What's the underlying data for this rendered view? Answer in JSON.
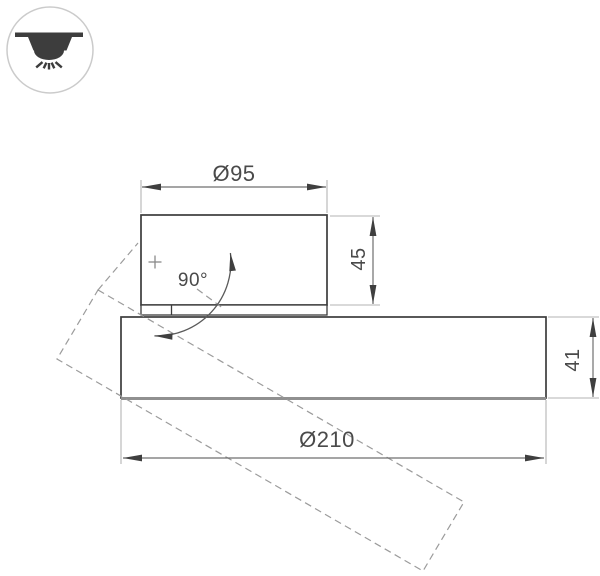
{
  "title": "luminaire-dimension-drawing",
  "badge": {
    "icon": "ceiling-downlight",
    "meaning": "surface ceiling mounted light"
  },
  "dimensions": {
    "top_diameter": "Ø95",
    "top_height": "45",
    "rotation_angle": "90°",
    "base_diameter": "Ø210",
    "base_height": "41"
  },
  "colors": {
    "solid_outline": "#3c3c3c",
    "dimension_line": "#6f6f6f",
    "extension_line": "#b3b3b3",
    "dashed_outline": "#9b9b9b",
    "text": "#4a4a4a",
    "icon": "#3d3d3d",
    "badge_border": "#cbcbcb",
    "background": "#ffffff"
  }
}
